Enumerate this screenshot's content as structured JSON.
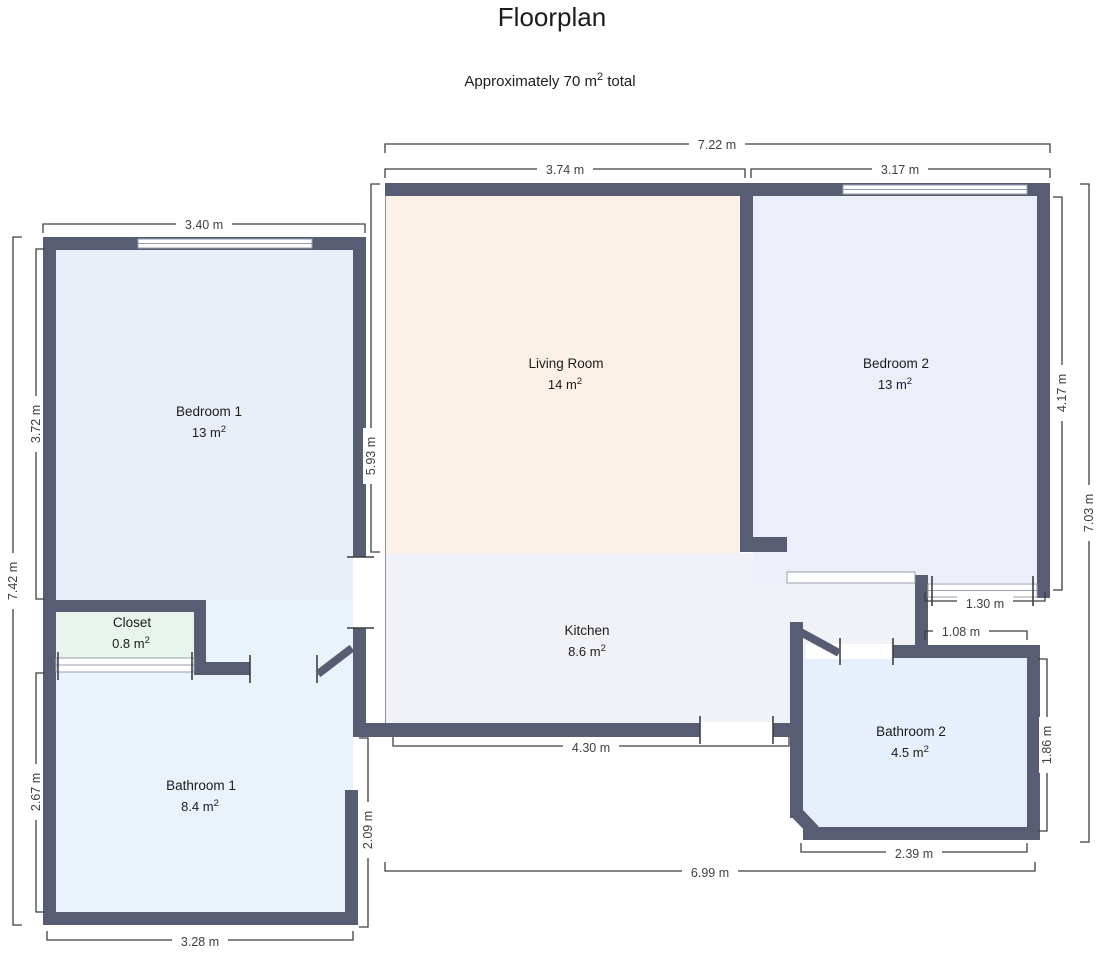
{
  "header": {
    "title": "Floorplan",
    "subtitle_main": "Approximately 70 m",
    "subtitle_sup": "2",
    "subtitle_tail": " total"
  },
  "rooms": {
    "bedroom1": {
      "name": "Bedroom 1",
      "area": "13 m",
      "sup": "2"
    },
    "closet": {
      "name": "Closet",
      "area": "0.8 m",
      "sup": "2"
    },
    "bathroom1": {
      "name": "Bathroom 1",
      "area": "8.4 m",
      "sup": "2"
    },
    "living_room": {
      "name": "Living Room",
      "area": "14 m",
      "sup": "2"
    },
    "kitchen": {
      "name": "Kitchen",
      "area": "8.6 m",
      "sup": "2"
    },
    "bedroom2": {
      "name": "Bedroom 2",
      "area": "13 m",
      "sup": "2"
    },
    "bathroom2": {
      "name": "Bathroom 2",
      "area": "4.5 m",
      "sup": "2"
    }
  },
  "dimensions": {
    "top_overall": "7.22 m",
    "living_room_top": "3.74 m",
    "bedroom2_top": "3.17 m",
    "bedroom1_top": "3.40 m",
    "left_overall": "7.42 m",
    "bedroom1_left": "3.72 m",
    "bathroom1_left": "2.67 m",
    "living_room_left": "5.93 m",
    "bedroom2_right": "4.17 m",
    "right_overall": "7.03 m",
    "bathroom2_right": "1.86 m",
    "bedroom2_door": "1.30 m",
    "bathroom2_top": "1.08 m",
    "kitchen_bottom": "4.30 m",
    "bathroom1_right": "2.09 m",
    "bathroom1_bottom": "3.28 m",
    "bottom_overall": "6.99 m",
    "bathroom2_bottom": "2.39 m"
  },
  "colors": {
    "wall": "#585d74",
    "dim_line": "#3f3f3f",
    "window_line": "#979dae",
    "text": "#1c1c1c",
    "bedroom1": "#eaeef9",
    "closet": "#e9f4ec",
    "bathroom1": "#eaf2fb",
    "living_room": "#fcf1e7",
    "kitchen": "#f1f1f8",
    "bedroom2": "#eceffa",
    "bathroom2": "#e6effb"
  }
}
